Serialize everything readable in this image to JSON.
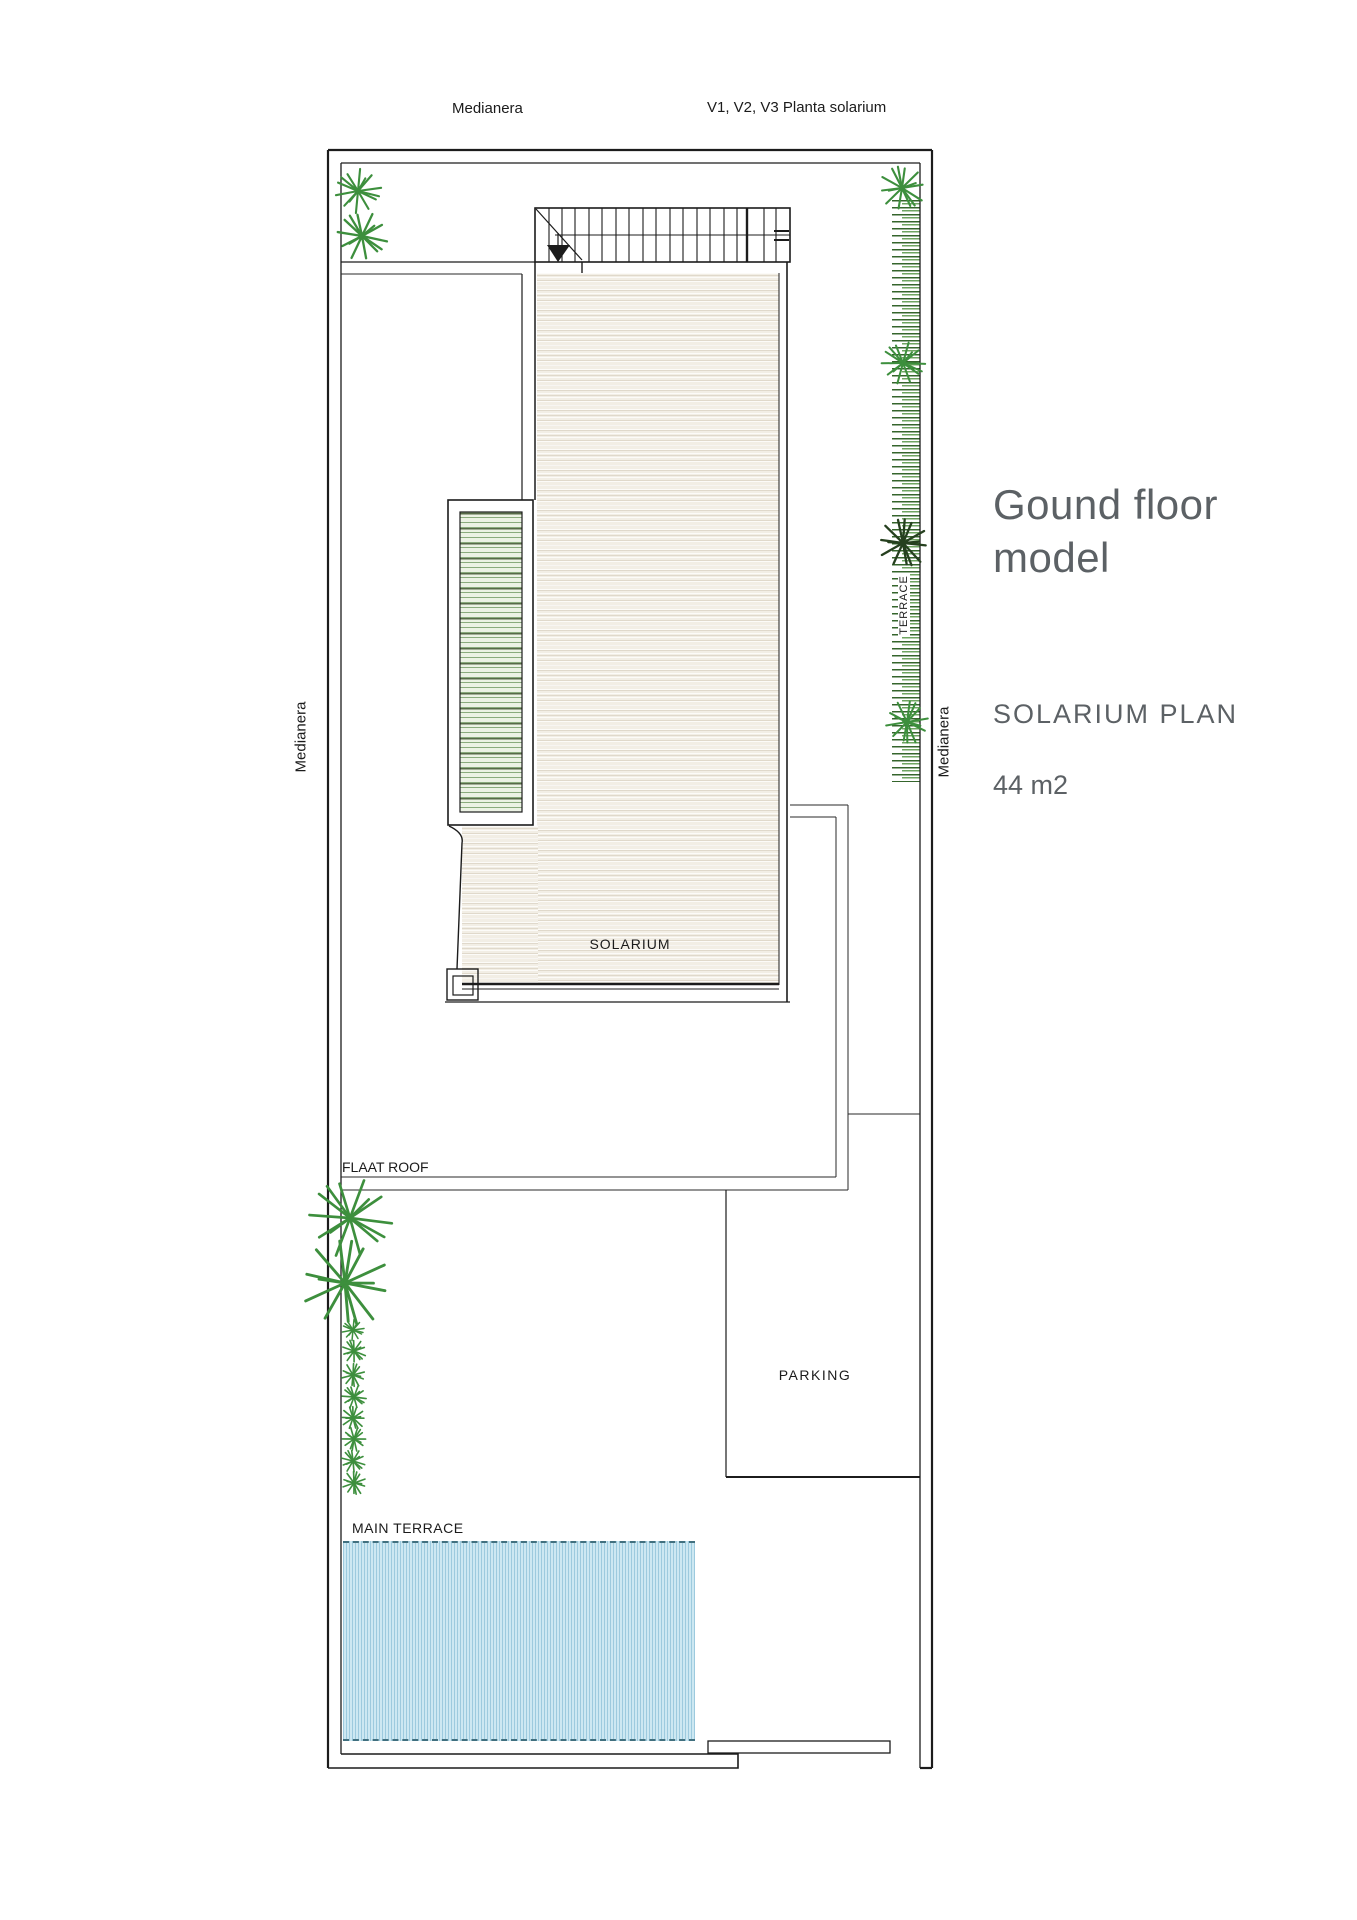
{
  "annotations": {
    "medianera_top": "Medianera",
    "plan_ref": "V1, V2, V3 Planta solarium",
    "medianera_left": "Medianera",
    "medianera_right": "Medianera",
    "terrace": "TERRACE",
    "solarium": "SOLARIUM",
    "flat_roof": "FLAAT ROOF",
    "parking": "PARKING",
    "main_terrace": "MAIN TERRACE"
  },
  "title_block": {
    "title_line1": "Gound floor",
    "title_line2": "model",
    "subtitle": "SOLARIUM PLAN",
    "area": "44 m2"
  },
  "colors": {
    "line": "#1c1c1c",
    "plant_green": "#3d8f3d",
    "plant_dark": "#26401f",
    "solarium_fill": "#f2eee5",
    "louver_fill": "#ecf2e4",
    "pool_fill": "#cde8f2",
    "hedge_green": "#35652c",
    "title_gray": "#5c6165",
    "label_black": "#1b1b1b"
  }
}
